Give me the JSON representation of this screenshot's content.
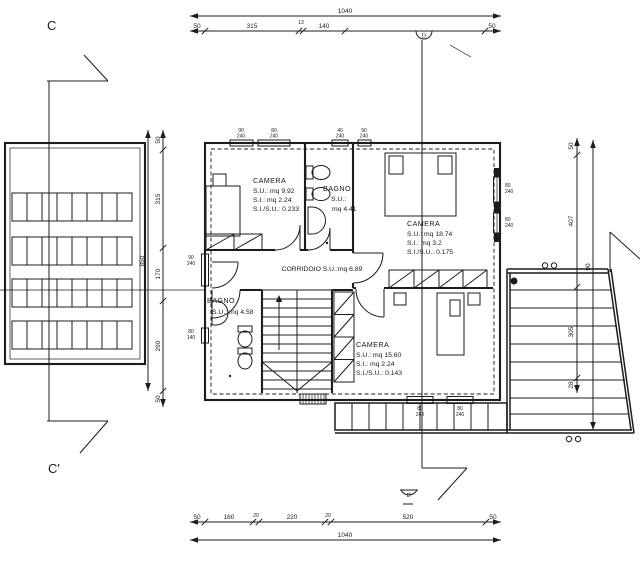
{
  "sections": {
    "top_left": "C",
    "bottom_left": "C'",
    "top_mid": "D",
    "bottom_mid": "D'"
  },
  "rooms": {
    "camera1": {
      "name": "CAMERA",
      "l1": "S.U.: mq 9.92",
      "l2": "S.I.: mq 2.24",
      "l3": "S.I./S.U.: 0.233"
    },
    "bagno1": {
      "name": "BAGNO",
      "l1": "S.U.:",
      "l2": "mq 4.41"
    },
    "camera2": {
      "name": "CAMERA",
      "l1": "S.U.: mq 18.74",
      "l2": "S.I.: mq 3.2",
      "l3": "S.I./S.U.: 0.175"
    },
    "corridoio": {
      "name": "CORRIDOIO S.U.:mq 6.89"
    },
    "bagno2": {
      "name": "BAGNO",
      "l1": "S.U.: mq 4.58"
    },
    "camera3": {
      "name": "CAMERA",
      "l1": "S.U.: mq 15.60",
      "l2": "S.I.: mq 2.24",
      "l3": "S.I./S.U.: 0.143"
    }
  },
  "dims": {
    "top_total": "1040",
    "top_segs": [
      "50",
      "315",
      "13",
      "140",
      "50"
    ],
    "bottom_total": "1040",
    "bottom_segs": [
      "50",
      "160",
      "20",
      "220",
      "20",
      "520",
      "50"
    ],
    "left_total": "850",
    "left_segs": [
      "50",
      "315",
      "170",
      "290",
      "50"
    ],
    "right_segs": [
      "50",
      "407",
      "305",
      "28"
    ],
    "right_inner": "90",
    "win_top": [
      [
        "90",
        "240"
      ],
      [
        "80",
        "240"
      ],
      [
        "40",
        "240"
      ],
      [
        "90",
        "240"
      ]
    ],
    "win_right": [
      [
        "80",
        "240"
      ],
      [
        "80",
        "240"
      ]
    ],
    "win_left": [
      [
        "90",
        "240"
      ],
      [
        "80",
        "140"
      ]
    ],
    "win_bottom": [
      [
        "80",
        "240"
      ],
      [
        "80",
        "240"
      ]
    ]
  }
}
